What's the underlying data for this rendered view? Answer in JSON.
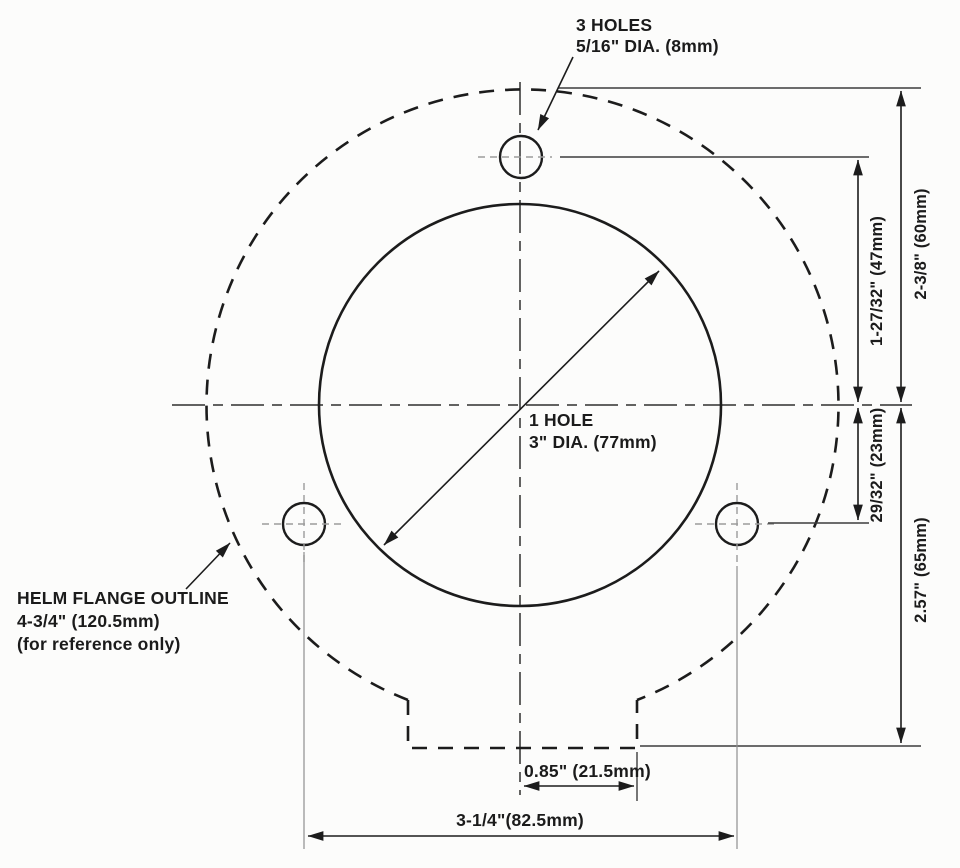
{
  "drawing": {
    "annotations": {
      "bolt_holes": {
        "line1": "3 HOLES",
        "line2": "5/16\" DIA. (8mm)"
      },
      "center_hole": {
        "line1": "1 HOLE",
        "line2": "3\" DIA. (77mm)"
      },
      "flange": {
        "line1": "HELM FLANGE OUTLINE",
        "line2": "4-3/4\" (120.5mm)",
        "line3": "(for reference only)"
      }
    },
    "dimensions": {
      "flange_top_to_centerline": "2-3/8\" (60mm)",
      "top_hole_to_centerline": "1-27/32\" (47mm)",
      "centerline_to_lower_holes": "29/32\" (23mm)",
      "centerline_to_bottom": "2.57\" (65mm)",
      "centerline_to_tab_edge": "0.85\" (21.5mm)",
      "lower_holes_spacing": "3-1/4\"(82.5mm)"
    },
    "colors": {
      "ink": "#1c1c1c",
      "paper": "#fcfcfb",
      "faint_line": "#8f8f8f"
    }
  }
}
